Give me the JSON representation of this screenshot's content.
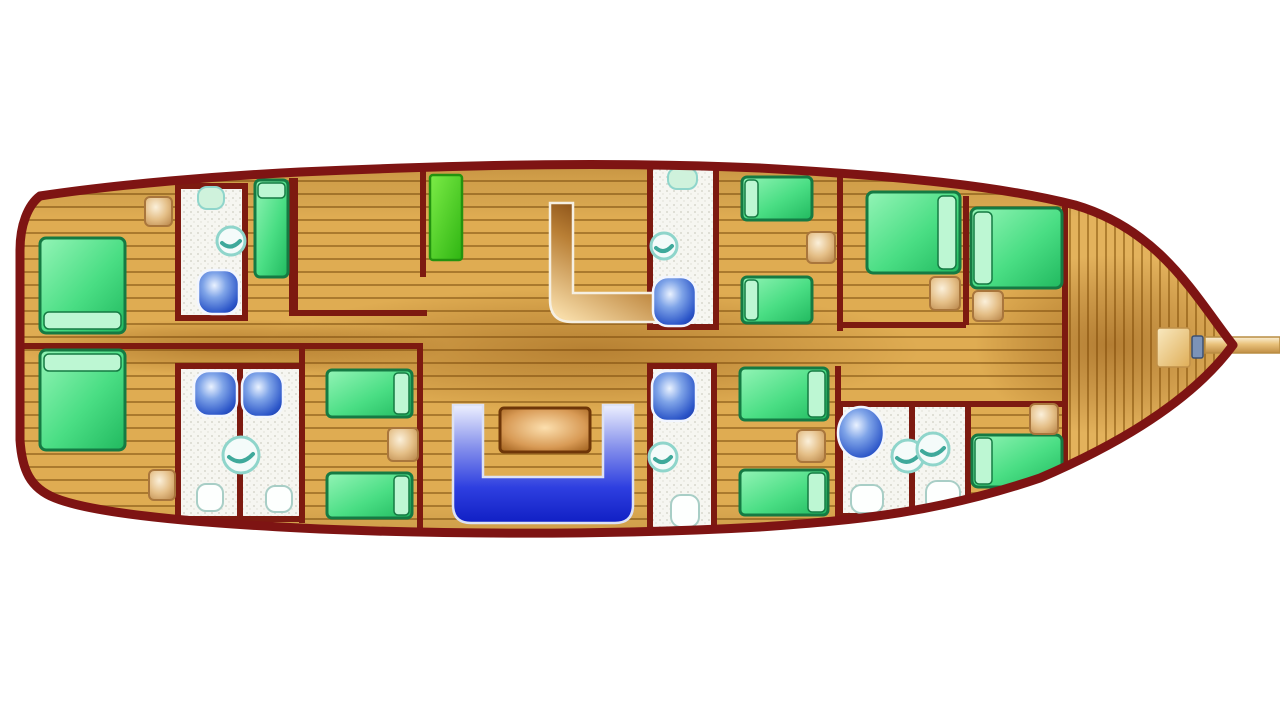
{
  "scene": {
    "type": "boat-deck-plan",
    "description": "Top-down interior cabin layout plan of a wooden gulet yacht, bow pointing right, bowsprit extending to right edge",
    "orientation": "bow-right"
  },
  "colors": {
    "background": "#FFFFFF",
    "hull_outline": "#7E1413",
    "wall": "#7D1A10",
    "wood_plank": "#DFAC52",
    "wood_plank_line": "#AA7A2E",
    "bow_plank": "#E3B25C",
    "bow_plank_line": "#B07F30",
    "bed_green": "#2EC46C",
    "bed_border": "#157A43",
    "bed_pillow": "#BDF7D3",
    "galley_green": "#52D92B",
    "nightstand_tan": "#E4BE86",
    "nightstand_border": "#A9763C",
    "bathroom_floor": "#F6F6F1",
    "basin_blue": "#2B55C8",
    "sink_teal": "#8FD5CB",
    "toilet_white": "#FDFFFE",
    "dinette_blue": "#1526D8",
    "dinette_blue_light": "#EDF0FF",
    "table_border": "#6E3608",
    "stairs_brown": "#7B3D07",
    "bowsprit_tan": "#E9C27B",
    "hatch_tan": "#F2D695",
    "bow_fitting_blue": "#7C93B8"
  },
  "inventory": {
    "double_beds": 5,
    "single_beds": 7,
    "nightstands": 8,
    "bathrooms": 7,
    "blue_wash_basins": 6,
    "round_sinks": 6,
    "toilets": 7,
    "galley_counters": 1,
    "stairs": 1,
    "dinette_sofas": 1,
    "dinette_tables": 1,
    "bow_hatches": 1,
    "bowsprits": 1
  },
  "areas": [
    {
      "name": "stern-port-cabin",
      "furniture": [
        "double-bed",
        "nightstand"
      ]
    },
    {
      "name": "stern-starboard-cabin",
      "furniture": [
        "double-bed",
        "nightstand"
      ]
    },
    {
      "name": "port-bathroom-aft",
      "furniture": [
        "toilet",
        "round-sink",
        "wash-basin"
      ]
    },
    {
      "name": "port-single-cabin",
      "furniture": [
        "single-bed"
      ]
    },
    {
      "name": "galley-area",
      "furniture": [
        "counter",
        "stairs"
      ]
    },
    {
      "name": "port-bathroom-mid",
      "furniture": [
        "toilet",
        "round-sink",
        "wash-basin"
      ]
    },
    {
      "name": "port-twin-cabin",
      "furniture": [
        "single-bed",
        "single-bed",
        "nightstand"
      ]
    },
    {
      "name": "port-forward-cabin-1",
      "furniture": [
        "double-bed",
        "nightstand"
      ]
    },
    {
      "name": "port-forward-cabin-2",
      "furniture": [
        "double-bed",
        "nightstand"
      ]
    },
    {
      "name": "starboard-bathroom-pair-aft",
      "furniture": [
        "wash-basin",
        "wash-basin",
        "round-sink",
        "toilet",
        "toilet"
      ]
    },
    {
      "name": "starboard-twin-cabin-aft",
      "furniture": [
        "single-bed",
        "single-bed",
        "nightstand"
      ]
    },
    {
      "name": "dinette",
      "furniture": [
        "u-shaped-sofa",
        "table"
      ]
    },
    {
      "name": "starboard-bathroom-mid",
      "furniture": [
        "wash-basin",
        "round-sink",
        "toilet"
      ]
    },
    {
      "name": "starboard-twin-cabin-mid",
      "furniture": [
        "single-bed",
        "single-bed",
        "nightstand"
      ]
    },
    {
      "name": "starboard-bathroom-pair-fwd",
      "furniture": [
        "wash-basin",
        "round-sink",
        "round-sink",
        "toilet",
        "toilet"
      ]
    },
    {
      "name": "starboard-forward-cabin",
      "furniture": [
        "double-bed",
        "nightstand"
      ]
    },
    {
      "name": "foredeck",
      "furniture": [
        "hatch",
        "bow-fitting",
        "bowsprit"
      ]
    }
  ]
}
